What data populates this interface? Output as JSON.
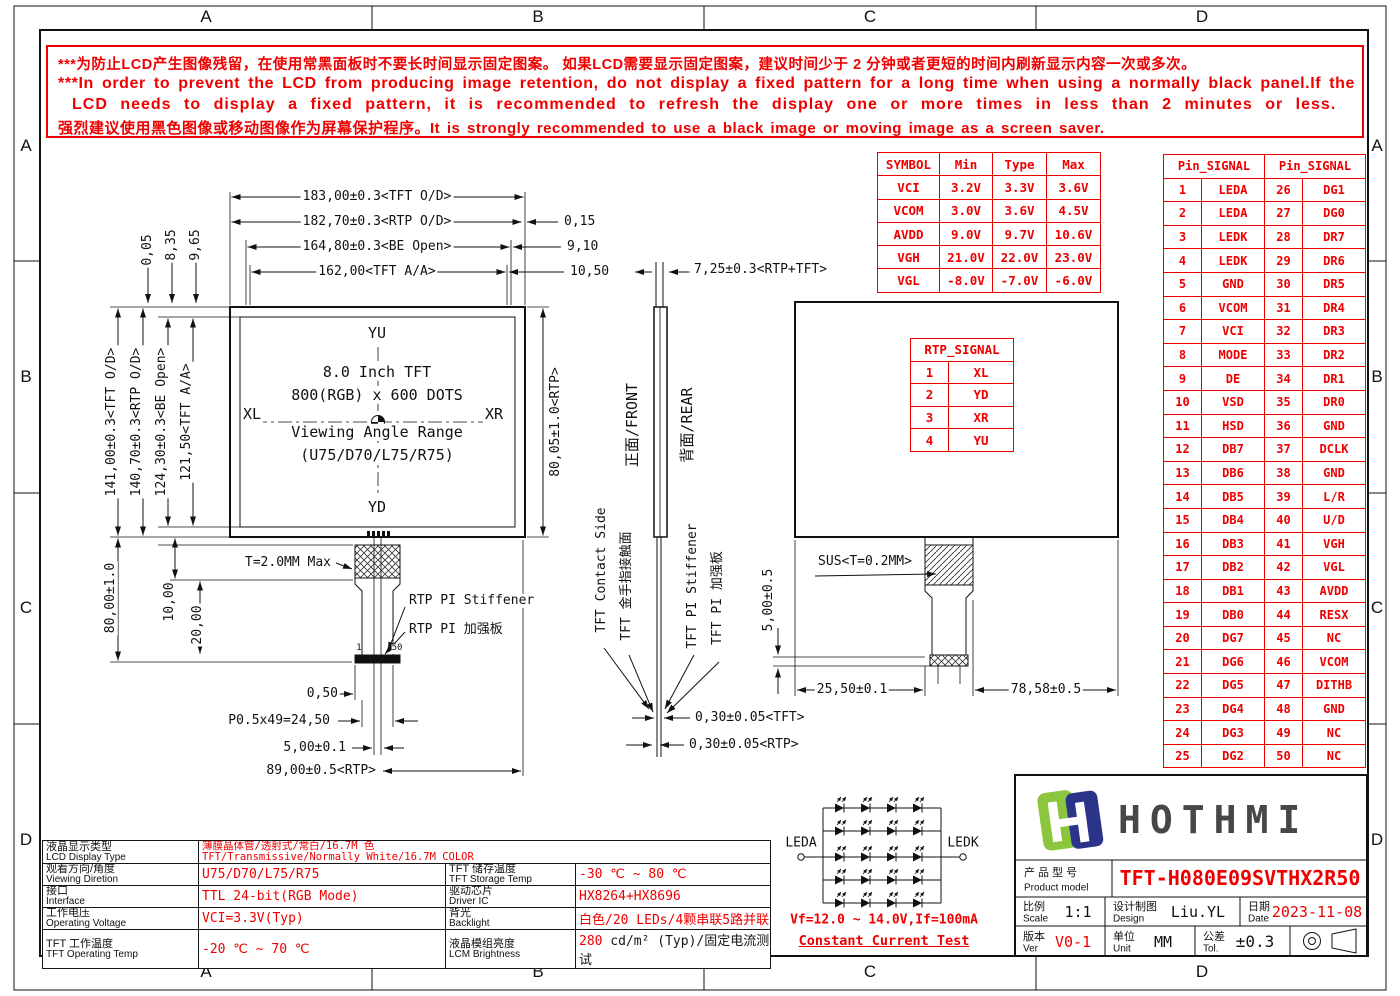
{
  "zones": {
    "letters": [
      "A",
      "B",
      "C",
      "D"
    ]
  },
  "warning": {
    "line1": "***为防止LCD产生图像残留，在使用常黑面板时不要长时间显示固定图案。 如果LCD需要显示固定图案，建议时间少于 2 分钟或者更短的时间内刷新显示内容一次或多次。",
    "line2": "***In order to prevent the LCD from producing image retention, do not display a fixed pattern for a long time when using a normally black panel.If the",
    "line3": "LCD needs to display a fixed pattern, it is recommended to refresh the display one or more times in less than 2 minutes or less.",
    "line4": "强烈建议使用黑色图像或移动图像作为屏幕保护程序。It is strongly recommended to use a black image or moving image as a screen saver."
  },
  "front_view": {
    "dim_183": "183,00±0.3<TFT O/D>",
    "dim_182": "182,70±0.3<RTP O/D>",
    "dim_164": "164,80±0.3<BE Open>",
    "dim_162": "162,00<TFT A/A>",
    "dim_015": "0,15",
    "dim_910": "9,10",
    "dim_1050": "10,50",
    "dim_005": "0,05",
    "dim_835": "8,35",
    "dim_965": "9,65",
    "dim_141": "141,00±0.3<TFT O/D>",
    "dim_140": "140,70±0.3<RTP O/D>",
    "dim_124": "124,30±0.3<BE Open>",
    "dim_121": "121,50<TFT A/A>",
    "dim_80": "80,00±1.0",
    "dim_10": "10,00",
    "dim_20": "20,00",
    "dim_8005": "80,05±1.0<RTP>",
    "label_yu": "YU",
    "label_yd": "YD",
    "label_xl": "XL",
    "label_xr": "XR",
    "center_line1": "8.0 Inch TFT",
    "center_line2": "800(RGB) x 600 DOTS",
    "center_line3": "Viewing Angle Range",
    "center_line4": "(U75/D70/L75/R75)",
    "t_max": "T=2.0MM Max",
    "stiffener_en": "RTP PI Stiffener",
    "stiffener_zh": "RTP PI 加强板",
    "pin_first": "1",
    "pin_last": "50",
    "dim_050": "0,50",
    "dim_pitch": "P0.5x49=24,50",
    "dim_500": "5,00±0.1",
    "dim_89": "89,00±0.5<RTP>"
  },
  "side_view": {
    "dim_725": "7,25±0.3<RTP+TFT>",
    "front_label": "正面/FRONT",
    "rear_label": "背面/REAR",
    "contact_en": "TFT Contact Side",
    "contact_zh": "TFT 金手指接触面",
    "stiffener_en": "TFT PI Stiffener",
    "stiffener_zh": "TFT PI 加强板",
    "dim_030_tft": "0,30±0.05<TFT>",
    "dim_030_rtp": "0,30±0.05<RTP>"
  },
  "rear_view": {
    "sus_label": "SUS<T=0.2MM>",
    "dim_500": "5,00±0.5",
    "dim_2550": "25,50±0.1",
    "dim_7858": "78,58±0.5"
  },
  "symbol_table": {
    "headers": [
      "SYMBOL",
      "Min",
      "Type",
      "Max"
    ],
    "rows": [
      {
        "sym": "VCI",
        "min": "3.2V",
        "typ": "3.3V",
        "max": "3.6V"
      },
      {
        "sym": "VCOM",
        "min": "3.0V",
        "typ": "3.6V",
        "max": "4.5V"
      },
      {
        "sym": "AVDD",
        "min": "9.0V",
        "typ": "9.7V",
        "max": "10.6V"
      },
      {
        "sym": "VGH",
        "min": "21.0V",
        "typ": "22.0V",
        "max": "23.0V"
      },
      {
        "sym": "VGL",
        "min": "-8.0V",
        "typ": "-7.0V",
        "max": "-6.0V"
      }
    ]
  },
  "rtp_table": {
    "header": "RTP_SIGNAL",
    "rows": [
      {
        "n": "1",
        "s": "XL"
      },
      {
        "n": "2",
        "s": "YD"
      },
      {
        "n": "3",
        "s": "XR"
      },
      {
        "n": "4",
        "s": "YU"
      }
    ]
  },
  "pin_table": {
    "header_left": "Pin_SIGNAL",
    "header_right": "Pin_SIGNAL",
    "rows": [
      {
        "n1": "1",
        "s1": "LEDA",
        "n2": "26",
        "s2": "DG1"
      },
      {
        "n1": "2",
        "s1": "LEDA",
        "n2": "27",
        "s2": "DG0"
      },
      {
        "n1": "3",
        "s1": "LEDK",
        "n2": "28",
        "s2": "DR7"
      },
      {
        "n1": "4",
        "s1": "LEDK",
        "n2": "29",
        "s2": "DR6"
      },
      {
        "n1": "5",
        "s1": "GND",
        "n2": "30",
        "s2": "DR5"
      },
      {
        "n1": "6",
        "s1": "VCOM",
        "n2": "31",
        "s2": "DR4"
      },
      {
        "n1": "7",
        "s1": "VCI",
        "n2": "32",
        "s2": "DR3"
      },
      {
        "n1": "8",
        "s1": "MODE",
        "n2": "33",
        "s2": "DR2"
      },
      {
        "n1": "9",
        "s1": "DE",
        "n2": "34",
        "s2": "DR1"
      },
      {
        "n1": "10",
        "s1": "VSD",
        "n2": "35",
        "s2": "DR0"
      },
      {
        "n1": "11",
        "s1": "HSD",
        "n2": "36",
        "s2": "GND"
      },
      {
        "n1": "12",
        "s1": "DB7",
        "n2": "37",
        "s2": "DCLK"
      },
      {
        "n1": "13",
        "s1": "DB6",
        "n2": "38",
        "s2": "GND"
      },
      {
        "n1": "14",
        "s1": "DB5",
        "n2": "39",
        "s2": "L/R"
      },
      {
        "n1": "15",
        "s1": "DB4",
        "n2": "40",
        "s2": "U/D"
      },
      {
        "n1": "16",
        "s1": "DB3",
        "n2": "41",
        "s2": "VGH"
      },
      {
        "n1": "17",
        "s1": "DB2",
        "n2": "42",
        "s2": "VGL"
      },
      {
        "n1": "18",
        "s1": "DB1",
        "n2": "43",
        "s2": "AVDD"
      },
      {
        "n1": "19",
        "s1": "DB0",
        "n2": "44",
        "s2": "RESX"
      },
      {
        "n1": "20",
        "s1": "DG7",
        "n2": "45",
        "s2": "NC"
      },
      {
        "n1": "21",
        "s1": "DG6",
        "n2": "46",
        "s2": "VCOM"
      },
      {
        "n1": "22",
        "s1": "DG5",
        "n2": "47",
        "s2": "DITHB"
      },
      {
        "n1": "23",
        "s1": "DG4",
        "n2": "48",
        "s2": "GND"
      },
      {
        "n1": "24",
        "s1": "DG3",
        "n2": "49",
        "s2": "NC"
      },
      {
        "n1": "25",
        "s1": "DG2",
        "n2": "50",
        "s2": "NC"
      }
    ]
  },
  "spec_table": {
    "r1_label_zh": "液晶显示类型",
    "r1_label_en": "LCD Display Type",
    "r1_value_line1": "薄膜晶体管/透射式/常白/16.7M 色",
    "r1_value_line2": "TFT/Transmissive/Normally White/16.7M COLOR",
    "r2_label_zh": "观看方向/角度",
    "r2_label_en": "Viewing Diretion",
    "r2_value": "U75/D70/L75/R75",
    "r2b_label_zh": "TFT 储存温度",
    "r2b_label_en": "TFT Storage Temp",
    "r2b_value": "-30 ℃ ~ 80 ℃",
    "r3_label_zh": "接口",
    "r3_label_en": "Interface",
    "r3_value": "TTL 24-bit(RGB Mode)",
    "r3b_label_zh": "驱动芯片",
    "r3b_label_en": "Driver IC",
    "r3b_value": "HX8264+HX8696",
    "r4_label_zh": "工作电压",
    "r4_label_en": "Operating Voltage",
    "r4_value": "VCI=3.3V(Typ)",
    "r4b_label_zh": "背光",
    "r4b_label_en": "Backlight",
    "r4b_value": "白色/20 LEDs/4颗串联5路并联",
    "r5_label_zh": "TFT 工作温度",
    "r5_label_en": "TFT Operating Temp",
    "r5_value": "-20 ℃ ~ 70 ℃",
    "r5b_label_zh": "液晶模组亮度",
    "r5b_label_en": "LCM Brightness",
    "r5b_value_red": "280",
    "r5b_value_rest": " cd/m² (Typ)/固定电流测试"
  },
  "led_circuit": {
    "anode": "LEDA",
    "cathode": "LEDK",
    "vf_text": "Vf=12.0 ~ 14.0V,If=100mA",
    "test_text": "Constant Current Test"
  },
  "title_block": {
    "brand": "HOTHMI",
    "model_label_zh": "产 品 型 号",
    "model_label_en": "Product model",
    "model": "TFT-H080E09SVTHX2R50",
    "scale_label_zh": "比例",
    "scale_label_en": "Scale",
    "scale": "1:1",
    "design_label_zh": "设计制图",
    "design_label_en": "Design",
    "design": "Liu.YL",
    "date_label_zh": "日期",
    "date_label_en": "Date",
    "date": "2023-11-08",
    "ver_label_zh": "版本",
    "ver_label_en": "Ver",
    "ver": "V0-1",
    "unit_label_zh": "单位",
    "unit_label_en": "Unit",
    "unit": "MM",
    "tol_label_zh": "公差",
    "tol_label_en": "Tol.",
    "tol": "±0.3"
  },
  "colors": {
    "red": "#ef0000",
    "line": "#111111",
    "logo_green": "#8cc63e",
    "logo_navy": "#2b3488"
  }
}
